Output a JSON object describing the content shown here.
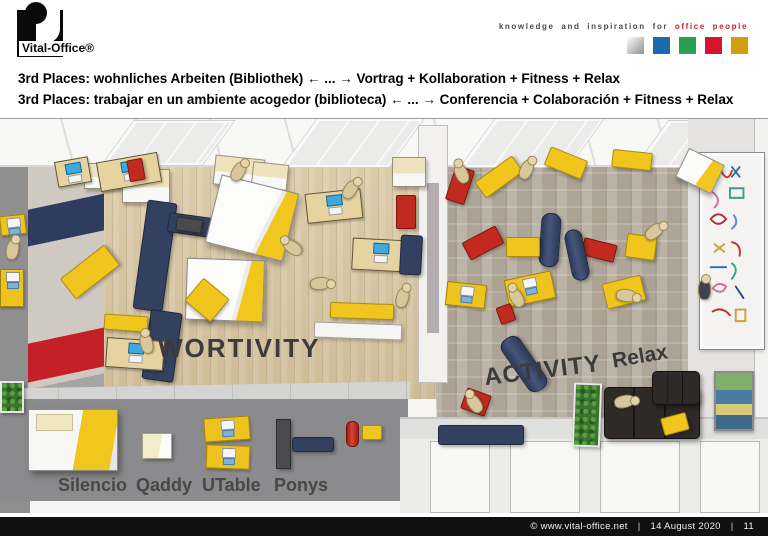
{
  "header": {
    "logo_text": "Vital-Office®",
    "tagline_plain": "knowledge and inspiration for",
    "tagline_accent": "office people",
    "accent_color": "#c9252c",
    "palette": [
      "linear-gradient(135deg,#ffffff 0%,#cccccc 45%,#8f8f8f 100%)",
      "#1b6ab0",
      "#2aa04e",
      "#d5152e",
      "#d49c12"
    ]
  },
  "title": {
    "line1": "3rd Places: wohnliches Arbeiten (Bibliothek) ← ... → Vortrag + Kollaboration + Fitness + Relax",
    "line2": "3rd Places: trabajar en un ambiente acogedor (biblioteca) ← ... → Conferencia + Colaboración + Fitness + Relax"
  },
  "scene": {
    "room_labels": {
      "left": "WORTIVITY",
      "right": "ACTIVITY",
      "relax": "Relax"
    },
    "legend_labels": [
      "Silencio",
      "Qaddy",
      "UTable",
      "Ponys"
    ],
    "furniture": [
      {
        "t": "cabinet",
        "x": 84,
        "y": 44,
        "w": 44,
        "h": 26,
        "r": 0
      },
      {
        "t": "cabinet",
        "x": 122,
        "y": 50,
        "w": 48,
        "h": 34,
        "r": 0
      },
      {
        "t": "cabinet",
        "x": 214,
        "y": 38,
        "w": 50,
        "h": 30,
        "r": 6
      },
      {
        "t": "cabinet",
        "x": 252,
        "y": 44,
        "w": 36,
        "h": 26,
        "r": 6
      },
      {
        "t": "cabinet",
        "x": 392,
        "y": 38,
        "w": 34,
        "h": 30,
        "r": 0
      },
      {
        "t": "desk",
        "x": 98,
        "y": 38,
        "w": 62,
        "h": 30,
        "r": -10
      },
      {
        "t": "desk",
        "x": 56,
        "y": 40,
        "w": 34,
        "h": 26,
        "r": -10
      },
      {
        "t": "red",
        "x": 128,
        "y": 40,
        "w": 16,
        "h": 22,
        "r": -10
      },
      {
        "t": "red",
        "x": 396,
        "y": 76,
        "w": 20,
        "h": 34,
        "r": 0
      },
      {
        "t": "navy",
        "x": 140,
        "y": 82,
        "w": 30,
        "h": 110,
        "r": 8
      },
      {
        "t": "navy",
        "x": 168,
        "y": 96,
        "w": 44,
        "h": 20,
        "r": 8
      },
      {
        "t": "dark",
        "x": 176,
        "y": 99,
        "w": 26,
        "h": 14,
        "r": 8
      },
      {
        "t": "navy",
        "x": 146,
        "y": 192,
        "w": 32,
        "h": 70,
        "r": 8
      },
      {
        "t": "cube",
        "x": 212,
        "y": 64,
        "w": 80,
        "h": 70,
        "r": 14
      },
      {
        "t": "cube",
        "x": 186,
        "y": 140,
        "w": 78,
        "h": 62,
        "r": 2
      },
      {
        "t": "yellow",
        "x": 62,
        "y": 140,
        "w": 56,
        "h": 26,
        "r": -38
      },
      {
        "t": "yellow",
        "x": 190,
        "y": 166,
        "w": 34,
        "h": 30,
        "r": 40
      },
      {
        "t": "desk",
        "x": 306,
        "y": 72,
        "w": 56,
        "h": 30,
        "r": -6
      },
      {
        "t": "desk",
        "x": 352,
        "y": 120,
        "w": 56,
        "h": 32,
        "r": 3
      },
      {
        "t": "navy",
        "x": 400,
        "y": 116,
        "w": 22,
        "h": 40,
        "r": 3
      },
      {
        "t": "desk",
        "x": 106,
        "y": 220,
        "w": 58,
        "h": 30,
        "r": 4
      },
      {
        "t": "yellow",
        "x": 104,
        "y": 196,
        "w": 44,
        "h": 16,
        "r": 4
      },
      {
        "t": "yellow",
        "x": 330,
        "y": 184,
        "w": 64,
        "h": 16,
        "r": 2
      },
      {
        "t": "whitef",
        "x": 314,
        "y": 204,
        "w": 88,
        "h": 16,
        "r": 2
      },
      {
        "t": "person",
        "x": 232,
        "y": 42,
        "r": 30
      },
      {
        "t": "person",
        "x": 344,
        "y": 60,
        "r": 35
      },
      {
        "t": "person",
        "x": 286,
        "y": 118,
        "r": -55
      },
      {
        "t": "person",
        "x": 314,
        "y": 154,
        "r": 85
      },
      {
        "t": "person",
        "x": 396,
        "y": 168,
        "r": 15
      },
      {
        "t": "person",
        "x": 140,
        "y": 214,
        "r": -15
      },
      {
        "t": "deskY",
        "x": 0,
        "y": 96,
        "w": 26,
        "h": 20,
        "r": -6
      },
      {
        "t": "deskY",
        "x": 0,
        "y": 150,
        "w": 24,
        "h": 38,
        "r": 0
      },
      {
        "t": "person",
        "x": 6,
        "y": 120,
        "r": 10
      },
      {
        "t": "plant",
        "x": 0,
        "y": 262,
        "w": 24,
        "h": 32,
        "r": 0
      },
      {
        "t": "red",
        "x": 450,
        "y": 48,
        "w": 20,
        "h": 36,
        "r": 18
      },
      {
        "t": "person",
        "x": 455,
        "y": 44,
        "r": -25
      },
      {
        "t": "yellow",
        "x": 476,
        "y": 48,
        "w": 46,
        "h": 20,
        "r": -36
      },
      {
        "t": "yellow",
        "x": 546,
        "y": 34,
        "w": 40,
        "h": 20,
        "r": 22
      },
      {
        "t": "yellow",
        "x": 612,
        "y": 32,
        "w": 40,
        "h": 18,
        "r": 6
      },
      {
        "t": "cubeS",
        "x": 680,
        "y": 36,
        "w": 40,
        "h": 32,
        "r": 26
      },
      {
        "t": "person",
        "x": 520,
        "y": 40,
        "r": 25
      },
      {
        "t": "red",
        "x": 464,
        "y": 114,
        "w": 38,
        "h": 20,
        "r": -28
      },
      {
        "t": "red",
        "x": 582,
        "y": 122,
        "w": 34,
        "h": 18,
        "r": 14
      },
      {
        "t": "roller",
        "x": 540,
        "y": 94,
        "w": 20,
        "h": 54,
        "r": 4
      },
      {
        "t": "roller",
        "x": 568,
        "y": 110,
        "w": 18,
        "h": 52,
        "r": -12
      },
      {
        "t": "yellow",
        "x": 506,
        "y": 118,
        "w": 34,
        "h": 20,
        "r": 0
      },
      {
        "t": "yellow",
        "x": 626,
        "y": 116,
        "w": 30,
        "h": 24,
        "r": 8
      },
      {
        "t": "person",
        "x": 648,
        "y": 102,
        "r": 50
      },
      {
        "t": "yellow",
        "x": 604,
        "y": 160,
        "w": 40,
        "h": 26,
        "r": -14
      },
      {
        "t": "person",
        "x": 620,
        "y": 166,
        "r": 95
      },
      {
        "t": "deskY",
        "x": 446,
        "y": 164,
        "w": 40,
        "h": 24,
        "r": 6
      },
      {
        "t": "deskY",
        "x": 506,
        "y": 156,
        "w": 48,
        "h": 28,
        "r": -12
      },
      {
        "t": "red",
        "x": 498,
        "y": 186,
        "w": 16,
        "h": 18,
        "r": -20
      },
      {
        "t": "person",
        "x": 510,
        "y": 168,
        "r": -30
      },
      {
        "t": "roller",
        "x": 513,
        "y": 214,
        "w": 22,
        "h": 62,
        "r": -35
      },
      {
        "t": "personD",
        "x": 698,
        "y": 160,
        "r": 0
      },
      {
        "t": "red",
        "x": 463,
        "y": 272,
        "w": 26,
        "h": 22,
        "r": 20
      },
      {
        "t": "person",
        "x": 468,
        "y": 274,
        "r": -35
      },
      {
        "t": "navy",
        "x": 438,
        "y": 306,
        "w": 86,
        "h": 20,
        "r": 0
      },
      {
        "t": "plant",
        "x": 573,
        "y": 264,
        "w": 28,
        "h": 64,
        "r": 2
      },
      {
        "t": "sofaB",
        "x": 604,
        "y": 268,
        "w": 96,
        "h": 52,
        "r": 0
      },
      {
        "t": "sofaB",
        "x": 652,
        "y": 252,
        "w": 48,
        "h": 34,
        "r": 0
      },
      {
        "t": "yellow",
        "x": 662,
        "y": 296,
        "w": 26,
        "h": 18,
        "r": -15
      },
      {
        "t": "person",
        "x": 618,
        "y": 272,
        "r": 78
      },
      {
        "t": "cubeL",
        "x": 28,
        "y": 290,
        "w": 90,
        "h": 62,
        "r": 0
      },
      {
        "t": "cubeS2",
        "x": 142,
        "y": 314,
        "w": 30,
        "h": 26,
        "r": 0
      },
      {
        "t": "deskY",
        "x": 204,
        "y": 298,
        "w": 46,
        "h": 24,
        "r": -4
      },
      {
        "t": "deskY",
        "x": 206,
        "y": 326,
        "w": 44,
        "h": 24,
        "r": 2
      },
      {
        "t": "dark",
        "x": 276,
        "y": 300,
        "w": 15,
        "h": 50,
        "r": 0
      },
      {
        "t": "navy",
        "x": 292,
        "y": 318,
        "w": 42,
        "h": 15,
        "r": 0
      },
      {
        "t": "redC",
        "x": 346,
        "y": 302,
        "w": 13,
        "h": 26,
        "r": 0
      },
      {
        "t": "yellow",
        "x": 362,
        "y": 306,
        "w": 20,
        "h": 15,
        "r": 0
      }
    ]
  },
  "footer": {
    "copyright": "©  www.vital-office.net",
    "separator": "|",
    "date": "14 August 2020",
    "page": "11"
  }
}
